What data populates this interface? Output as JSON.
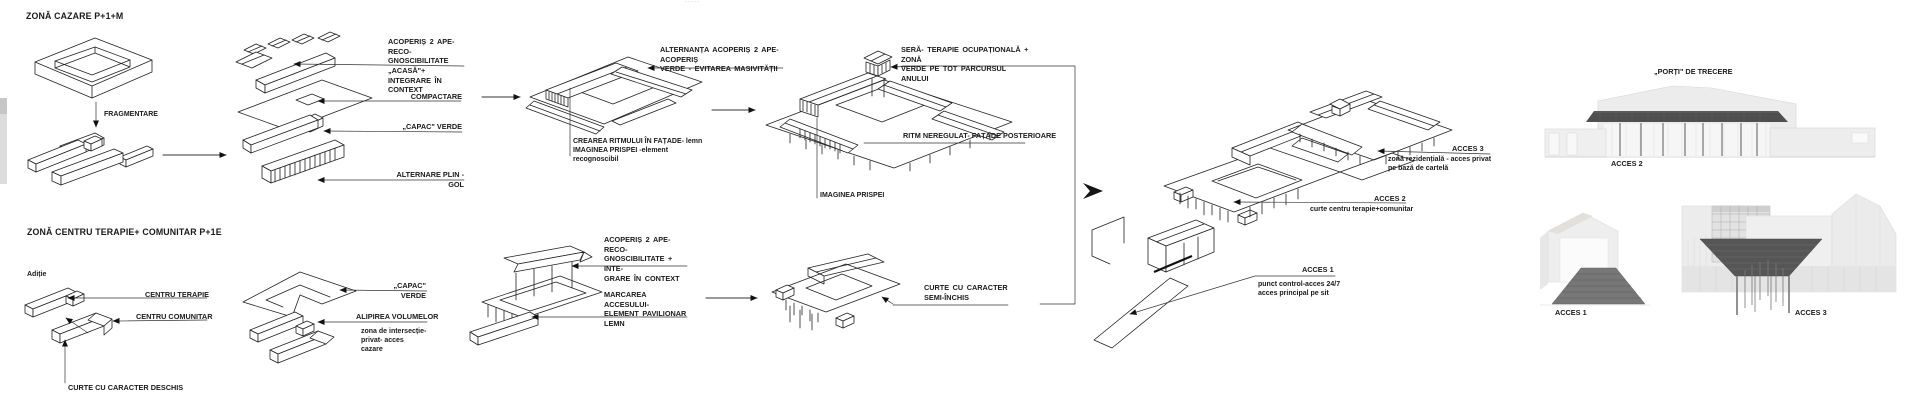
{
  "decor": {
    "top_marks": "·····"
  },
  "row_cazare": {
    "title": "ZONĂ CAZARE P+1+M",
    "fragmentare": "FRAGMENTARE",
    "labels": {
      "acoperis": [
        "ACOPERIȘ 2 APE- RECO-",
        "GNOSCIBILITATE „ACASĂ\"+",
        "INTEGRARE ÎN CONTEXT"
      ],
      "compactare": "COMPACTARE",
      "capac_verde": "„CAPAC\" VERDE",
      "alternare": "ALTERNARE PLIN -GOL",
      "alternanta": [
        "ALTERNANȚA  ACOPERIȘ 2 APE-ACOPERIȘ",
        "VERDE - EVITAREA MASIVITĂȚII"
      ],
      "crearea": [
        "CREAREA RITMULUI ÎN FAȚADE- lemn",
        "IMAGINEA PRISPEI -element recognoscibil"
      ],
      "sera": [
        "SERĂ- TERAPIE OCUPAȚIONALĂ + ZONĂ",
        "VERDE PE TOT PARCURSUL ANULUI"
      ],
      "ritm": "RITM NEREGULAT- FAȚADE POSTERIOARE",
      "imaginea_prispei": "IMAGINEA PRISPEI"
    }
  },
  "row_terapie": {
    "title": "ZONĂ CENTRU TERAPIE+ COMUNITAR P+1E",
    "aditie": "Adiție",
    "labels": {
      "centru_terapie": "CENTRU TERAPIE",
      "centru_comunitar": "CENTRU COMUNITAR",
      "curte_deschisa": "CURTE CU CARACTER DESCHIS",
      "capac_verde": "„CAPAC\" VERDE",
      "alipirea": "ALIPIREA VOLUMELOR",
      "zona_intersectie": [
        "zona  de  intersecție-",
        "privat- acces cazare"
      ],
      "acoperis": [
        "ACOPERIȘ 2 APE- RECO-",
        "GNOSCIBILITATE + INTE-",
        "GRARE ÎN CONTEXT"
      ],
      "marcarea": [
        "MARCAREA   ACCESULUI-",
        "ELEMENT   PAVILIONAR",
        "LEMN"
      ],
      "curte_semi": [
        "CURTE  CU  CARACTER",
        "SEMI-ÎNCHIS"
      ]
    }
  },
  "final_scheme": {
    "acces3_title": "ACCES 3",
    "acces3_desc": [
      "zonă  rezidențială  -  acces  privat",
      "pe bază de cartelă"
    ],
    "acces2_title": "ACCES 2",
    "acces2_desc": "curte centru terapie+comunitar",
    "acces1_title": "ACCES 1",
    "acces1_desc": [
      "punct control-acces 24/7",
      "acces principal pe sit"
    ]
  },
  "renders": {
    "title": "„PORȚI\" DE TRECERE",
    "acces2": "ACCES 2",
    "acces1": "ACCES 1",
    "acces3": "ACCES 3"
  }
}
